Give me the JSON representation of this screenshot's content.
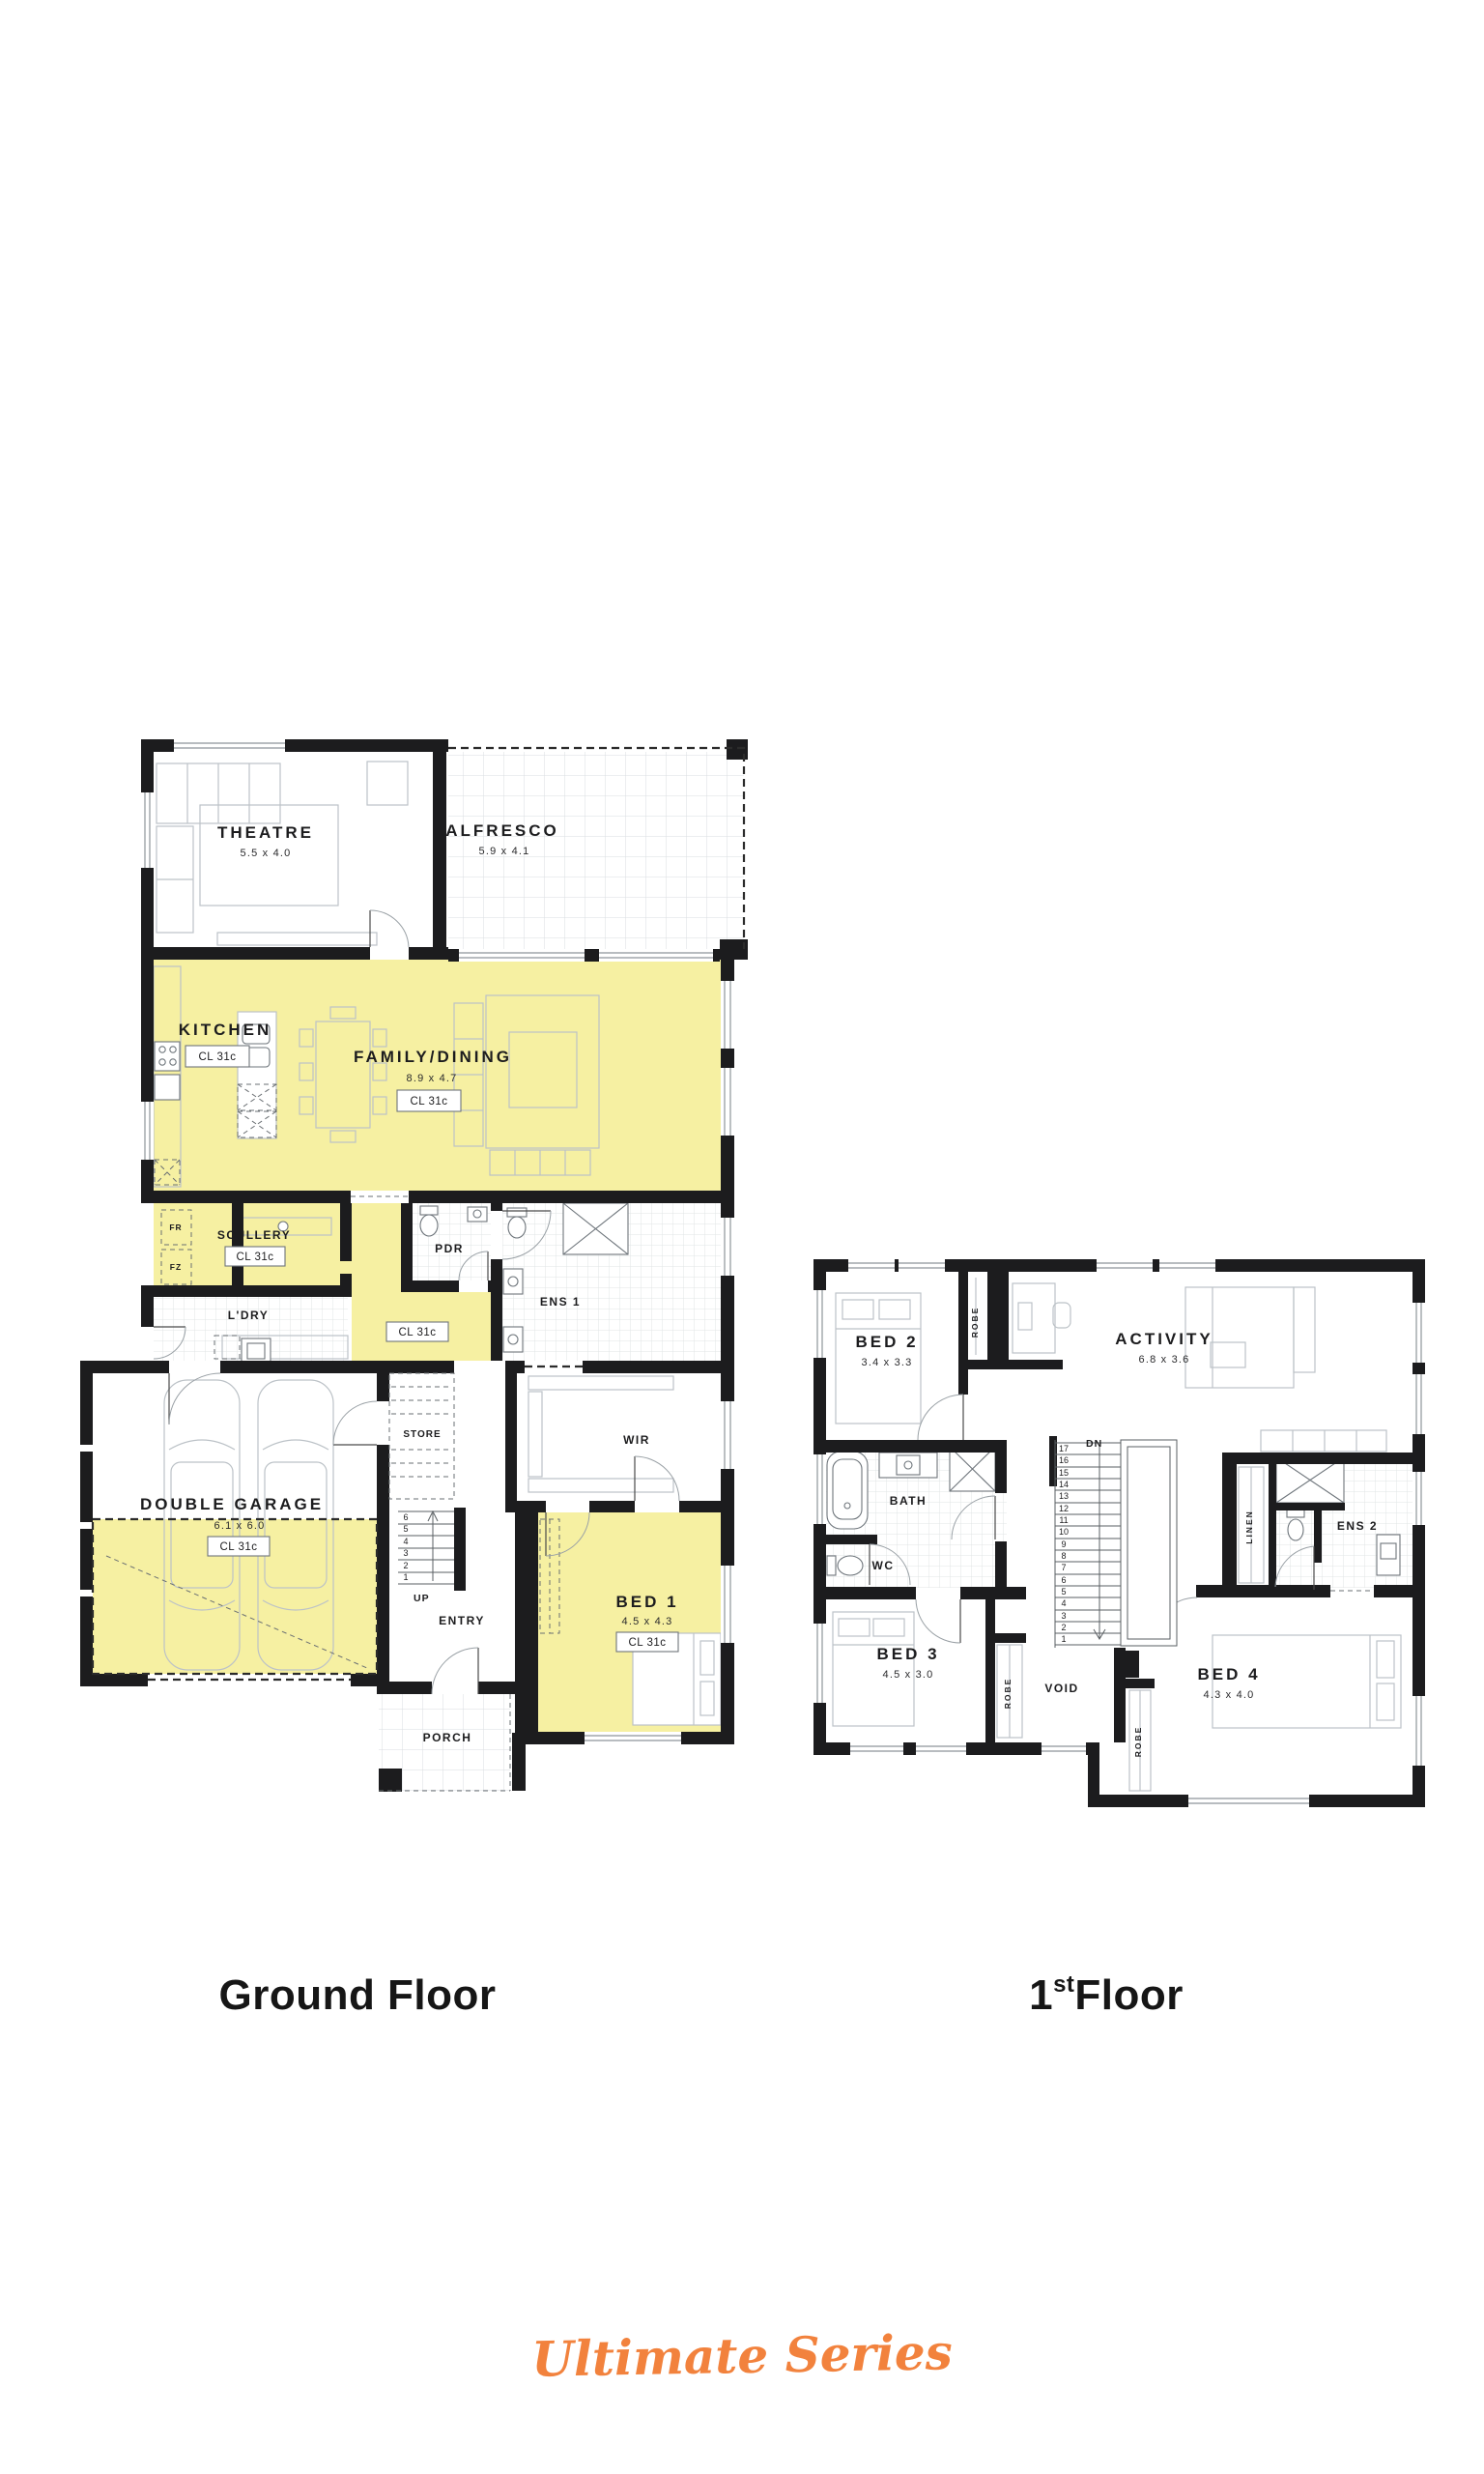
{
  "colors": {
    "highlight": "#f6f0a2",
    "wall": "#1c1c1e",
    "accent": "#f2823d"
  },
  "ground_floor": {
    "caption": "Ground Floor",
    "hall_badge": "CL 31c",
    "appliances": {
      "fridge": "FR",
      "freezer": "FZ"
    },
    "stairs": {
      "label": "UP",
      "numbers": [
        "6",
        "5",
        "4",
        "3",
        "2",
        "1"
      ]
    },
    "rooms": {
      "theatre": {
        "label": "THEATRE",
        "dim": "5.5 x 4.0"
      },
      "alfresco": {
        "label": "ALFRESCO",
        "dim": "5.9 x 4.1"
      },
      "kitchen": {
        "label": "KITCHEN",
        "badge": "CL 31c"
      },
      "family_dining": {
        "label": "FAMILY/DINING",
        "dim": "8.9 x 4.7",
        "badge": "CL 31c"
      },
      "scullery": {
        "label": "SCULLERY",
        "badge": "CL 31c"
      },
      "laundry": {
        "label": "L'DRY"
      },
      "pdr": {
        "label": "PDR"
      },
      "ens1": {
        "label": "ENS 1"
      },
      "store": {
        "label": "STORE"
      },
      "wir": {
        "label": "WIR"
      },
      "garage": {
        "label": "DOUBLE GARAGE",
        "dim": "6.1 x 6.0",
        "badge": "CL 31c"
      },
      "entry": {
        "label": "ENTRY"
      },
      "bed1": {
        "label": "BED 1",
        "dim": "4.5 x 4.3",
        "badge": "CL 31c"
      },
      "porch": {
        "label": "PORCH"
      }
    }
  },
  "first_floor": {
    "caption": {
      "number": "1",
      "ordinal": "st",
      "word": "Floor"
    },
    "stairs": {
      "label": "DN",
      "numbers": [
        "17",
        "16",
        "15",
        "14",
        "13",
        "12",
        "11",
        "10",
        "9",
        "8",
        "7",
        "6",
        "5",
        "4",
        "3",
        "2",
        "1"
      ]
    },
    "labels": {
      "robe_bed2": "ROBE",
      "robe_bed3": "ROBE",
      "robe_bed4": "ROBE",
      "linen": "LINEN"
    },
    "rooms": {
      "bed2": {
        "label": "BED 2",
        "dim": "3.4 x 3.3"
      },
      "activity": {
        "label": "ACTIVITY",
        "dim": "6.8 x 3.6"
      },
      "bath": {
        "label": "BATH"
      },
      "wc": {
        "label": "WC"
      },
      "bed3": {
        "label": "BED 3",
        "dim": "4.5 x 3.0"
      },
      "void": {
        "label": "VOID"
      },
      "bed4": {
        "label": "BED 4",
        "dim": "4.3 x 4.0"
      },
      "ens2": {
        "label": "ENS 2"
      }
    }
  },
  "footer": {
    "brand": "Ultimate Series"
  }
}
